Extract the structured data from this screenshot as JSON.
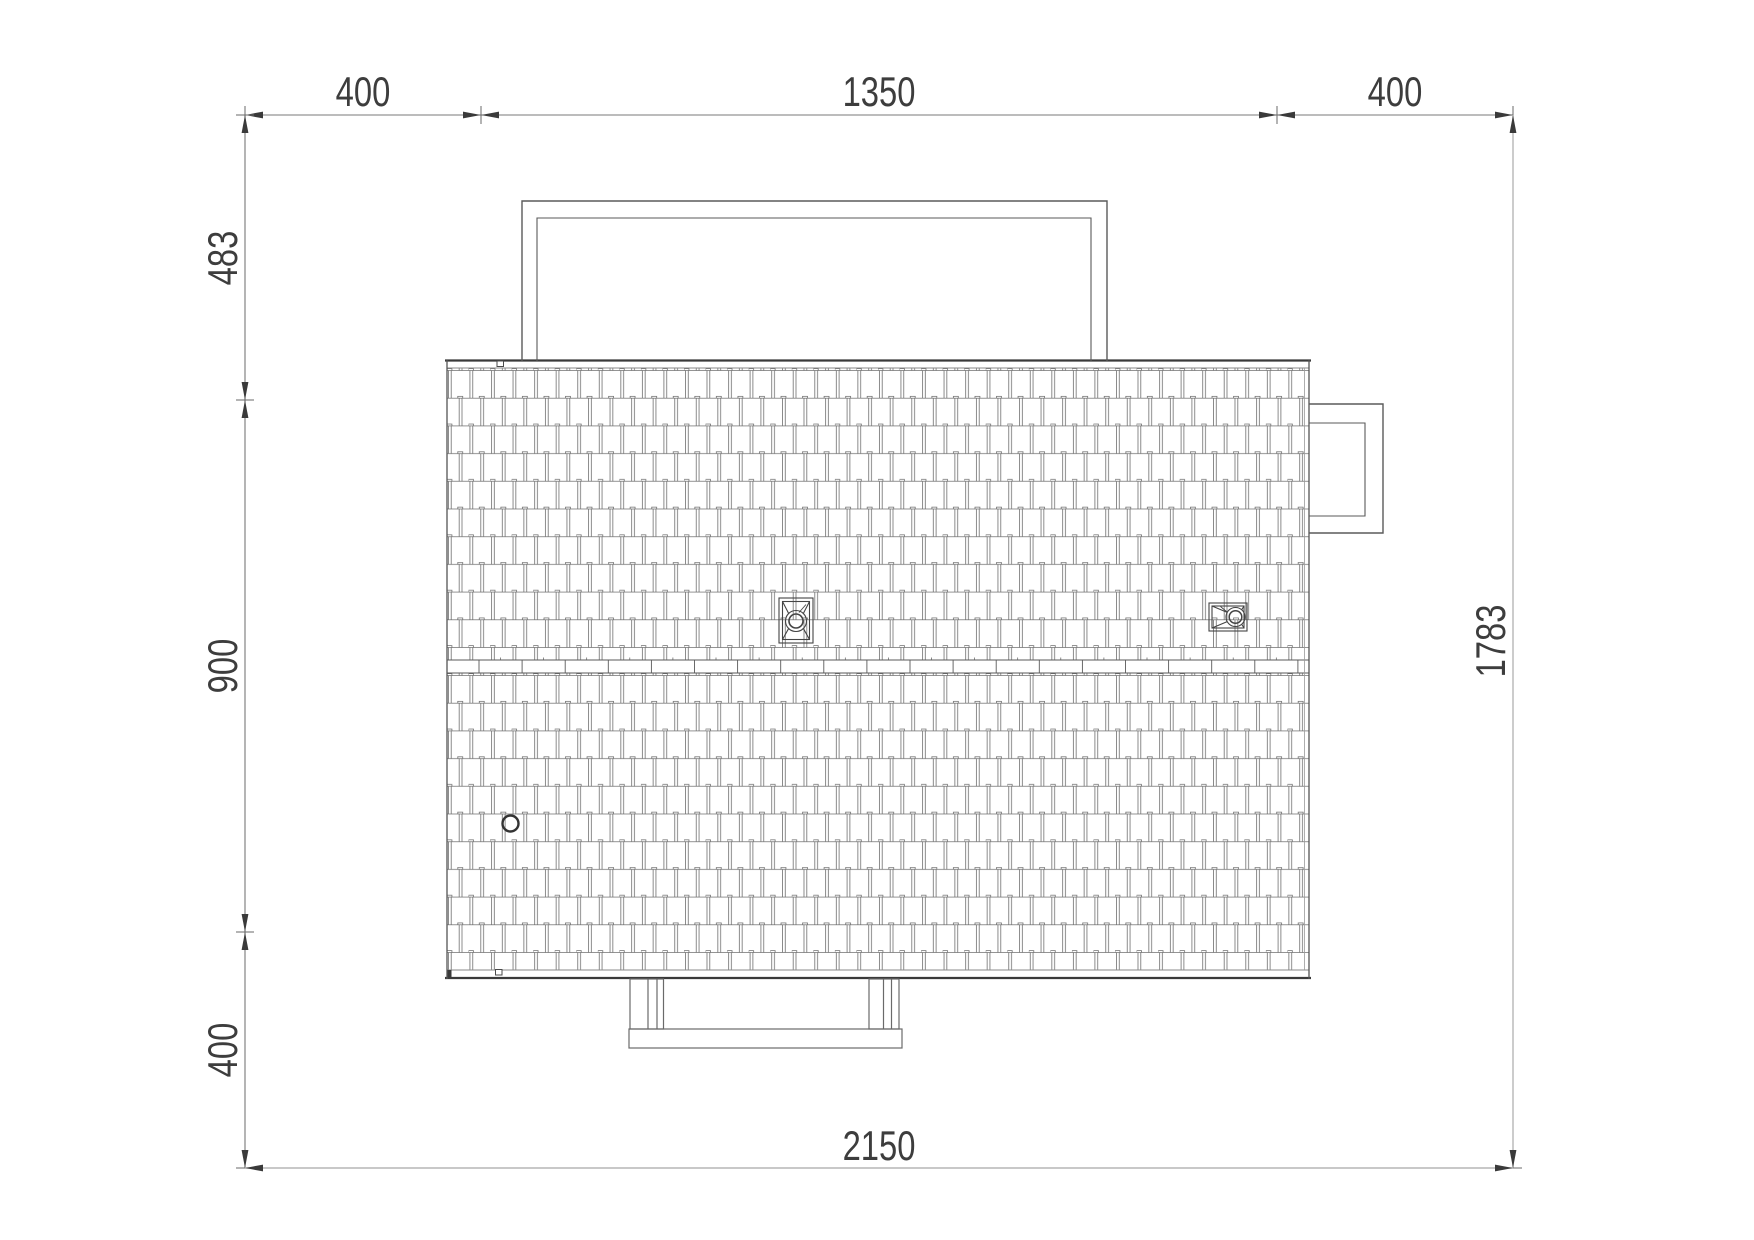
{
  "document": {
    "type": "architectural-roof-plan",
    "background": "#ffffff"
  },
  "dimensions": {
    "top": {
      "segments": [
        {
          "label": "400"
        },
        {
          "label": "1350"
        },
        {
          "label": "400"
        }
      ]
    },
    "left": {
      "segments": [
        {
          "label": "483"
        },
        {
          "label": "900"
        },
        {
          "label": "400"
        }
      ]
    },
    "right": {
      "overall": {
        "label": "1783"
      }
    },
    "bottom": {
      "overall": {
        "label": "2150"
      }
    }
  },
  "colors": {
    "line_dark": "#3a3a3a",
    "line_medium": "#787878",
    "line_light": "#b6b6b6",
    "tile_stroke": "#6f6f6f",
    "text": "#3d3d3d"
  }
}
